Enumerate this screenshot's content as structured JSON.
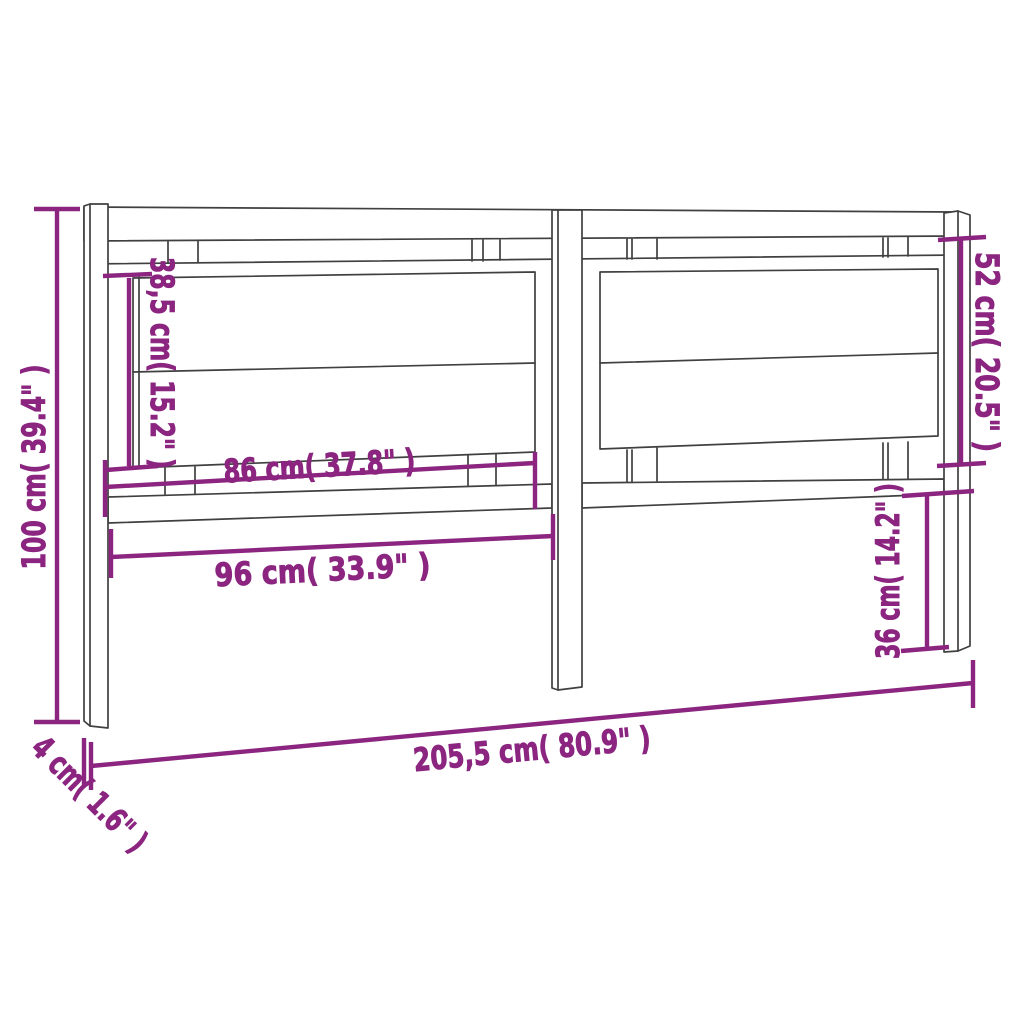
{
  "diagram": {
    "accent_color": "#8b2580",
    "line_color": "#404040",
    "background_color": "#ffffff",
    "dimensions": {
      "overall_height": "100 cm( 39.4\" )",
      "panel_height_left": "38,5 cm( 15.2\" )",
      "panel_width": "86 cm( 37.8\" )",
      "opening_width": "96 cm( 33.9\" )",
      "panel_height_right": "52 cm( 20.5\" )",
      "leg_height_right": "36 cm( 14.2\" )",
      "overall_width": "205,5 cm( 80.9\" )",
      "depth": "4 cm( 1.6\" )"
    }
  }
}
